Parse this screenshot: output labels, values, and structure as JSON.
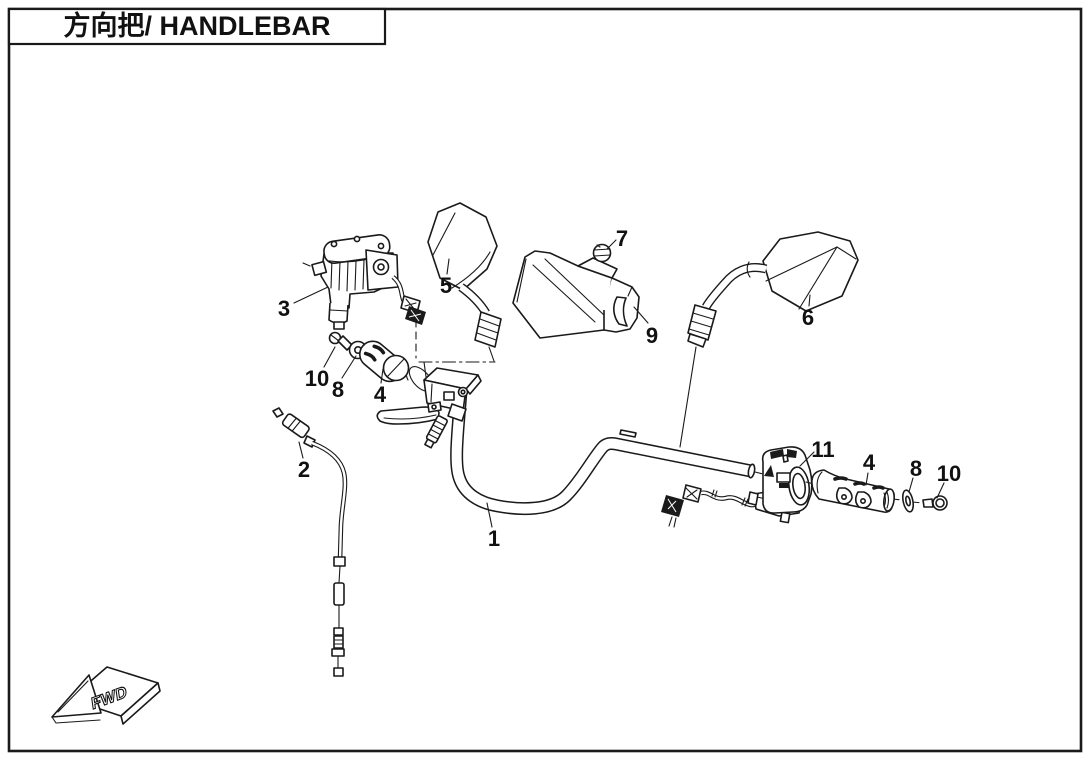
{
  "page": {
    "background_color": "#ffffff",
    "line_color": "#1a1a1a"
  },
  "header": {
    "title": "方向把/ HANDLEBAR"
  },
  "orientation_marker": {
    "label": "FWD",
    "direction": "forward-lower-left"
  },
  "diagram": {
    "kind": "exploded-parts-view",
    "subject": "handlebar assembly",
    "callouts": [
      {
        "number": "1",
        "part": "handlebar-tube"
      },
      {
        "number": "2",
        "part": "throttle-cable"
      },
      {
        "number": "3",
        "part": "left-brake-master-cylinder"
      },
      {
        "number": "4",
        "part": "left-handle-grip"
      },
      {
        "number": "5",
        "part": "left-rearview-mirror"
      },
      {
        "number": "6",
        "part": "right-rearview-mirror"
      },
      {
        "number": "7",
        "part": "screw"
      },
      {
        "number": "8",
        "part": "left-grip-washer"
      },
      {
        "number": "9",
        "part": "handlebar-cover"
      },
      {
        "number": "10",
        "part": "left-grip-bolt"
      },
      {
        "number": "11",
        "part": "right-switch-assembly"
      },
      {
        "number": "4",
        "part": "right-handle-grip"
      },
      {
        "number": "8",
        "part": "right-grip-washer"
      },
      {
        "number": "10",
        "part": "right-grip-bolt"
      }
    ]
  }
}
